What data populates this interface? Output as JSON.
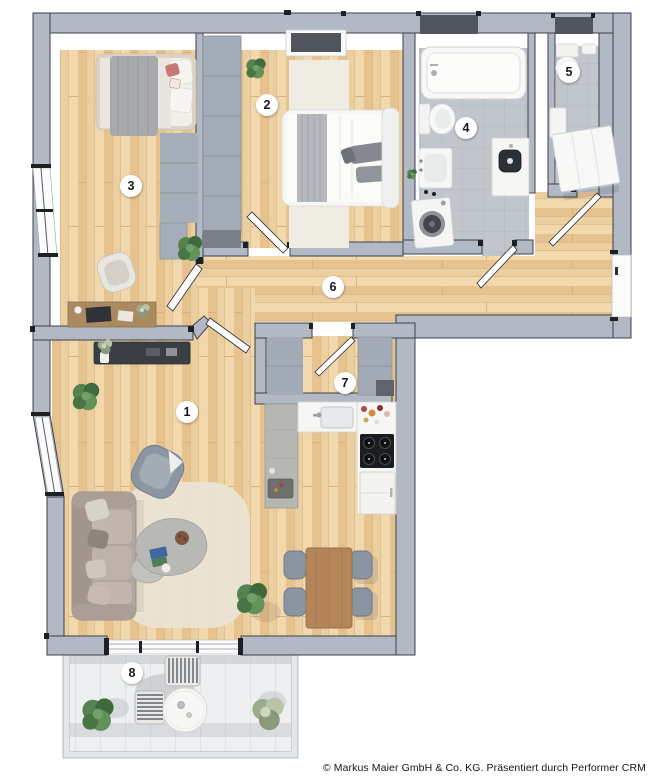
{
  "rooms": [
    {
      "label": "1"
    },
    {
      "label": "2"
    },
    {
      "label": "3"
    },
    {
      "label": "4"
    },
    {
      "label": "5"
    },
    {
      "label": "6"
    },
    {
      "label": "7"
    },
    {
      "label": "8"
    }
  ],
  "footer": {
    "copyright": "© Markus Maier GmbH & Co. KG. Präsentiert durch Performer CRM"
  },
  "palette": {
    "wall": "#b2b9c4",
    "wall_outline": "#3c414c",
    "wood_floor": "#eccfa0",
    "tile_floor": "#c1c6cc",
    "window_recess": "#50555e",
    "balcony_floor": "#edeff1"
  }
}
